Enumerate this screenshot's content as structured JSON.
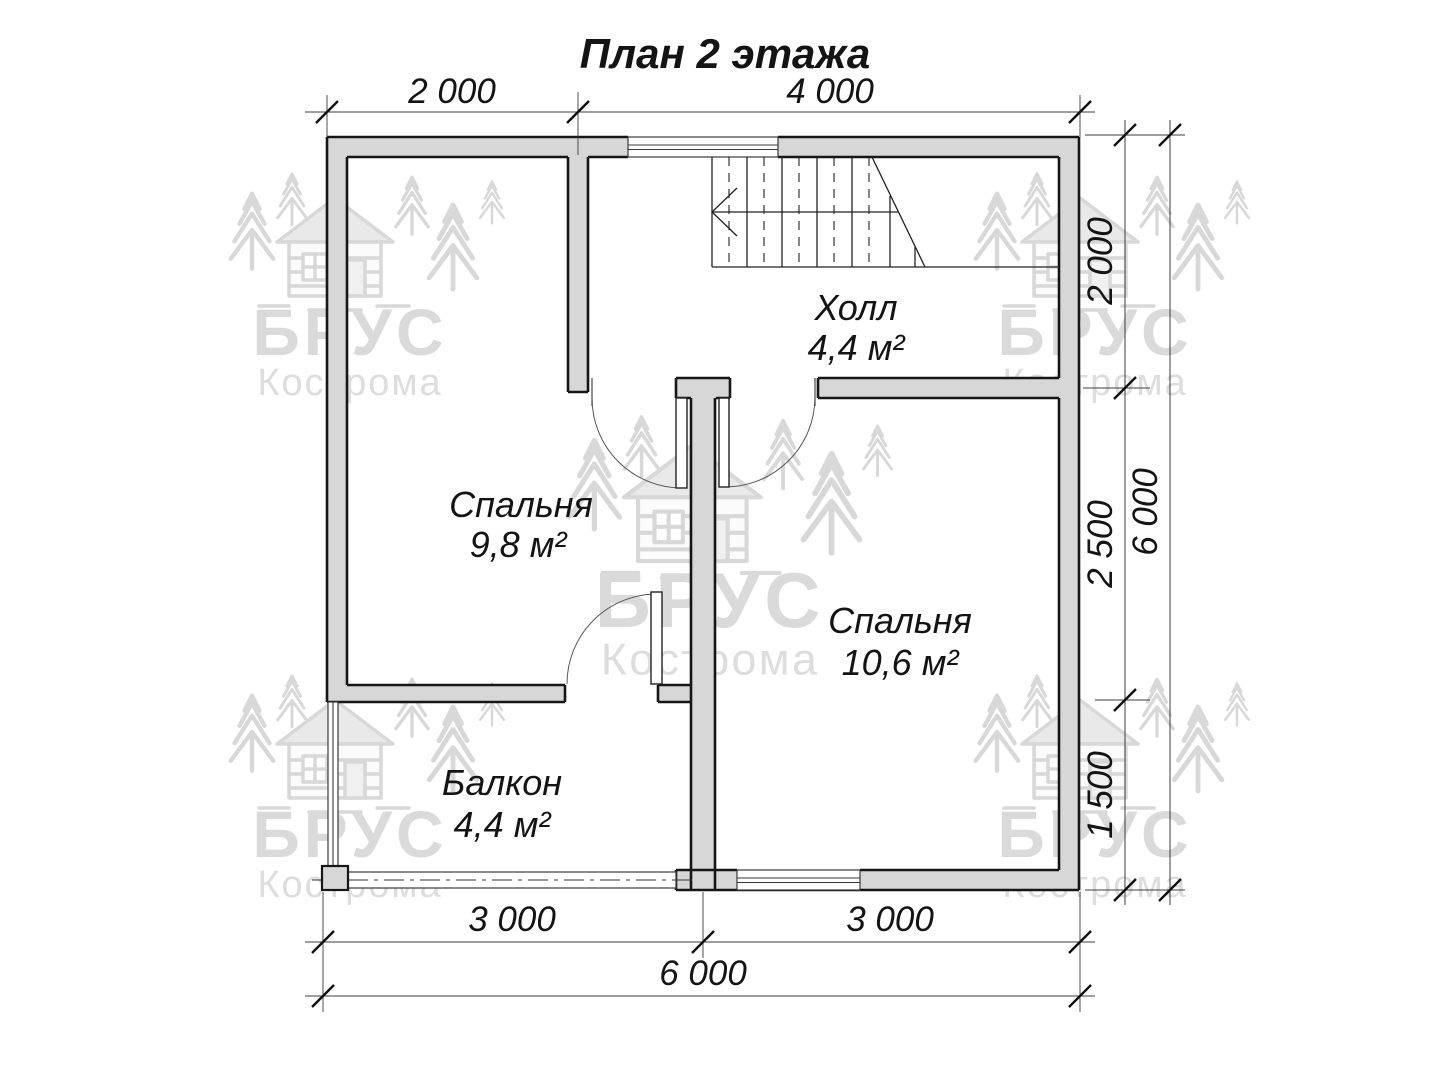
{
  "title": "План 2 этажа",
  "watermark": {
    "brand": "БРУС",
    "city": "Кострома"
  },
  "rooms": {
    "hall": {
      "name": "Холл",
      "area": "4,4 м²"
    },
    "bedroom_small": {
      "name": "Спальня",
      "area": "9,8 м²"
    },
    "bedroom_large": {
      "name": "Спальня",
      "area": "10,6 м²"
    },
    "balcony": {
      "name": "Балкон",
      "area": "4,4 м²"
    }
  },
  "dimensions": {
    "top": {
      "left": "2 000",
      "right": "4 000"
    },
    "right_side": {
      "top": "2 000",
      "middle": "2 500",
      "bottom": "1 500",
      "total": "6 000"
    },
    "bottom": {
      "left": "3 000",
      "right": "3 000",
      "total": "6 000"
    }
  }
}
